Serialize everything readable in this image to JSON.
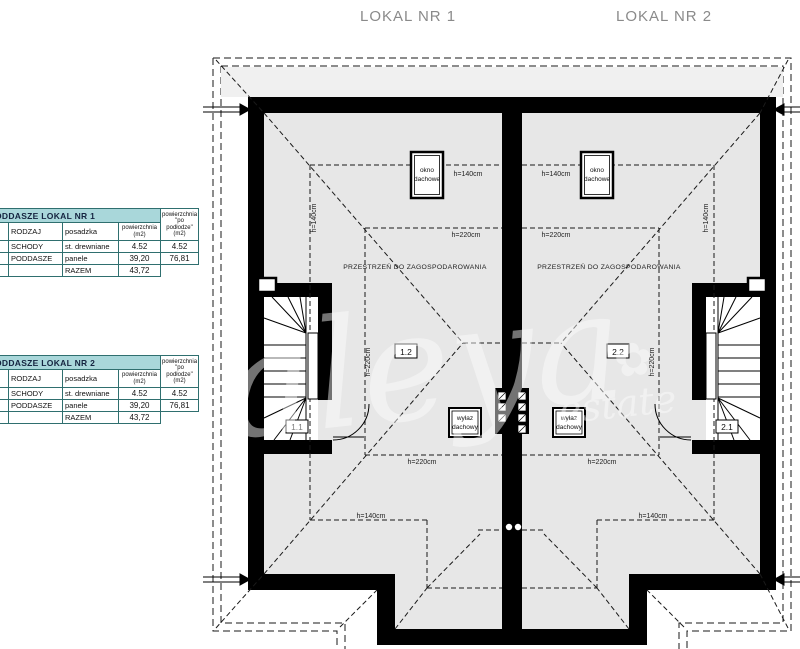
{
  "page": {
    "lokal1": "LOKAL NR 1",
    "lokal2": "LOKAL NR 2"
  },
  "tables": [
    {
      "title": "PODDASZE LOKAL NR 1",
      "col_rodzaj": "RODZAJ",
      "col_posadzka": "posadzka",
      "col_pow_l1": "powierzchnia",
      "col_pow_l2": "(m2)",
      "col_pow2_l1": "powierzchnia",
      "col_pow2_l2": "\"po podłodze\"",
      "col_pow2_l3": "(m2)",
      "rows": [
        {
          "rodzaj": "SCHODY",
          "posadzka": "st. drewniane",
          "pow": "4.52",
          "pow2": "4.52"
        },
        {
          "rodzaj": "PODDASZE",
          "posadzka": "panele",
          "pow": "39,20",
          "pow2": "76,81"
        },
        {
          "rodzaj": "",
          "posadzka": "RAZEM",
          "pow": "43,72",
          "pow2": ""
        }
      ]
    },
    {
      "title": "PODDASZE LOKAL NR 2",
      "col_rodzaj": "RODZAJ",
      "col_posadzka": "posadzka",
      "col_pow_l1": "powierzchnia",
      "col_pow_l2": "(m2)",
      "col_pow2_l1": "powierzchnia",
      "col_pow2_l2": "\"po podłodze\"",
      "col_pow2_l3": "(m2)",
      "rows": [
        {
          "rodzaj": "SCHODY",
          "posadzka": "st. drewniane",
          "pow": "4.52",
          "pow2": "4.52"
        },
        {
          "rodzaj": "PODDASZE",
          "posadzka": "panele",
          "pow": "39,20",
          "pow2": "76,81"
        },
        {
          "rodzaj": "",
          "posadzka": "RAZEM",
          "pow": "43,72",
          "pow2": ""
        }
      ]
    }
  ],
  "plan": {
    "dim_h140": "h=140cm",
    "dim_h220": "h=220cm",
    "przestrzen": "PRZESTRZEŃ DO ZAGOSPODAROWANIA",
    "okno_l1": "okno",
    "okno_l2": "dachowe",
    "wylaz_l1": "wyłaz",
    "wylaz_l2": "dachowy",
    "room_11": "1.1",
    "room_12": "1.2",
    "room_21": "2.1",
    "room_22": "2.2",
    "watermark_main": "aleya",
    "watermark_sub": "estate",
    "watermark_flower": "✿",
    "colors": {
      "wall": "#000000",
      "floor": "#e7e7e7",
      "table_header_bg": "#a9d7da",
      "table_border": "#2f6f6f"
    }
  }
}
